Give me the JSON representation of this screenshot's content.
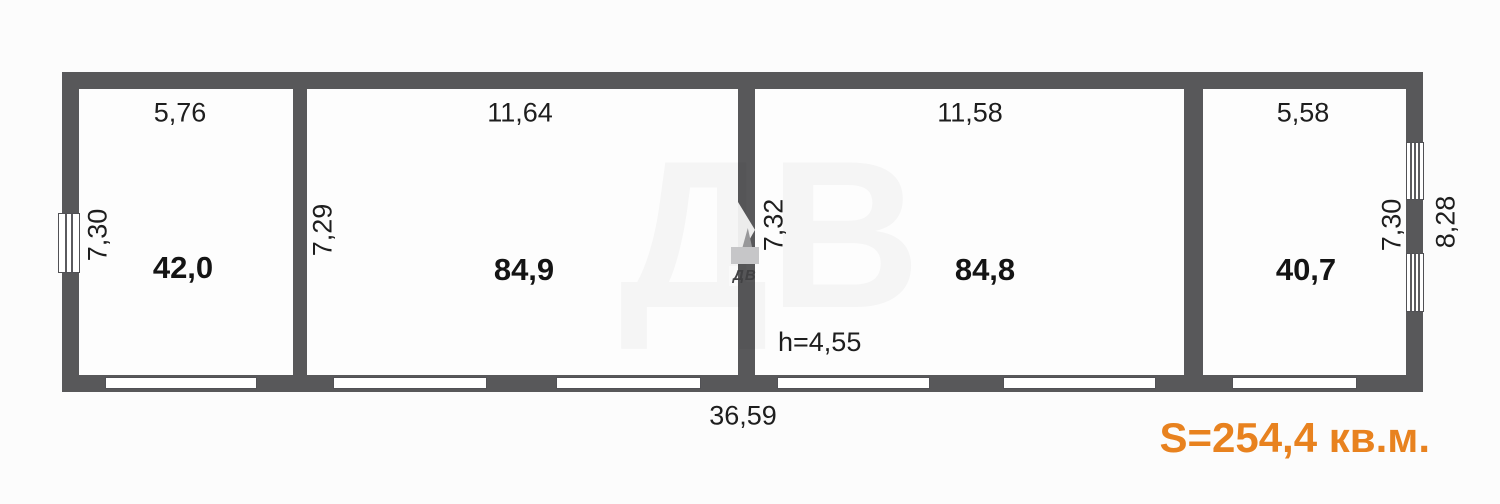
{
  "colors": {
    "wall": "#58585a",
    "accent_orange": "#e8821f",
    "background": "#fcfcfc",
    "text": "#1e1e1e"
  },
  "plan": {
    "rooms": [
      {
        "name": "room-1",
        "area_label": "42,0",
        "top_dim": "5,76",
        "side_dim": "7,30"
      },
      {
        "name": "room-2",
        "area_label": "84,9",
        "top_dim": "11,64",
        "side_dim": "7,29"
      },
      {
        "name": "room-3",
        "area_label": "84,8",
        "top_dim": "11,58",
        "side_dim": "7,32",
        "height_note": "h=4,55"
      },
      {
        "name": "room-4",
        "area_label": "40,7",
        "top_dim": "5,58",
        "side_dim": "7,30"
      }
    ],
    "bottom_total_dim": "36,59",
    "right_outer_dim": "8,28",
    "total_area_label": "S=254,4 кв.м."
  },
  "watermark": {
    "logo_text": "ДВ"
  }
}
